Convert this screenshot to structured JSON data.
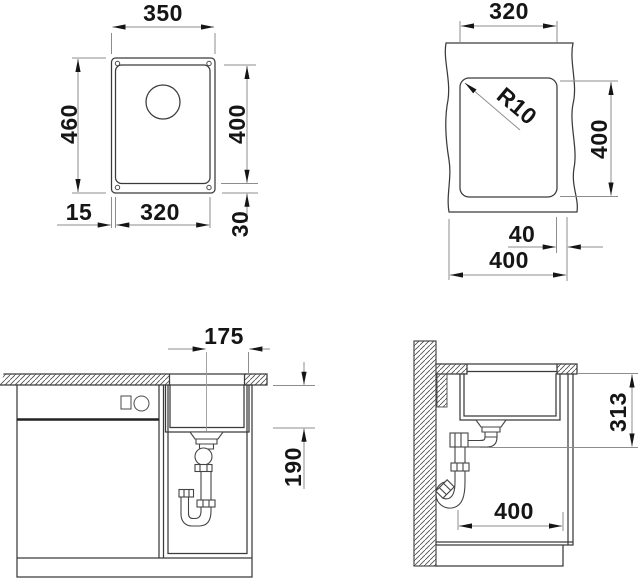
{
  "dims": {
    "top": {
      "overall_width": "350",
      "overall_depth": "460",
      "bowl_depth": "400",
      "rim_left": "15",
      "bowl_width": "320",
      "rim_bottom": "30"
    },
    "cutout": {
      "width": "320",
      "radius": "R10",
      "depth": "400",
      "offset": "40",
      "total": "400"
    },
    "front": {
      "center_offset": "175",
      "bowl_height": "190"
    },
    "side": {
      "drain_height": "313",
      "depth": "400"
    }
  }
}
